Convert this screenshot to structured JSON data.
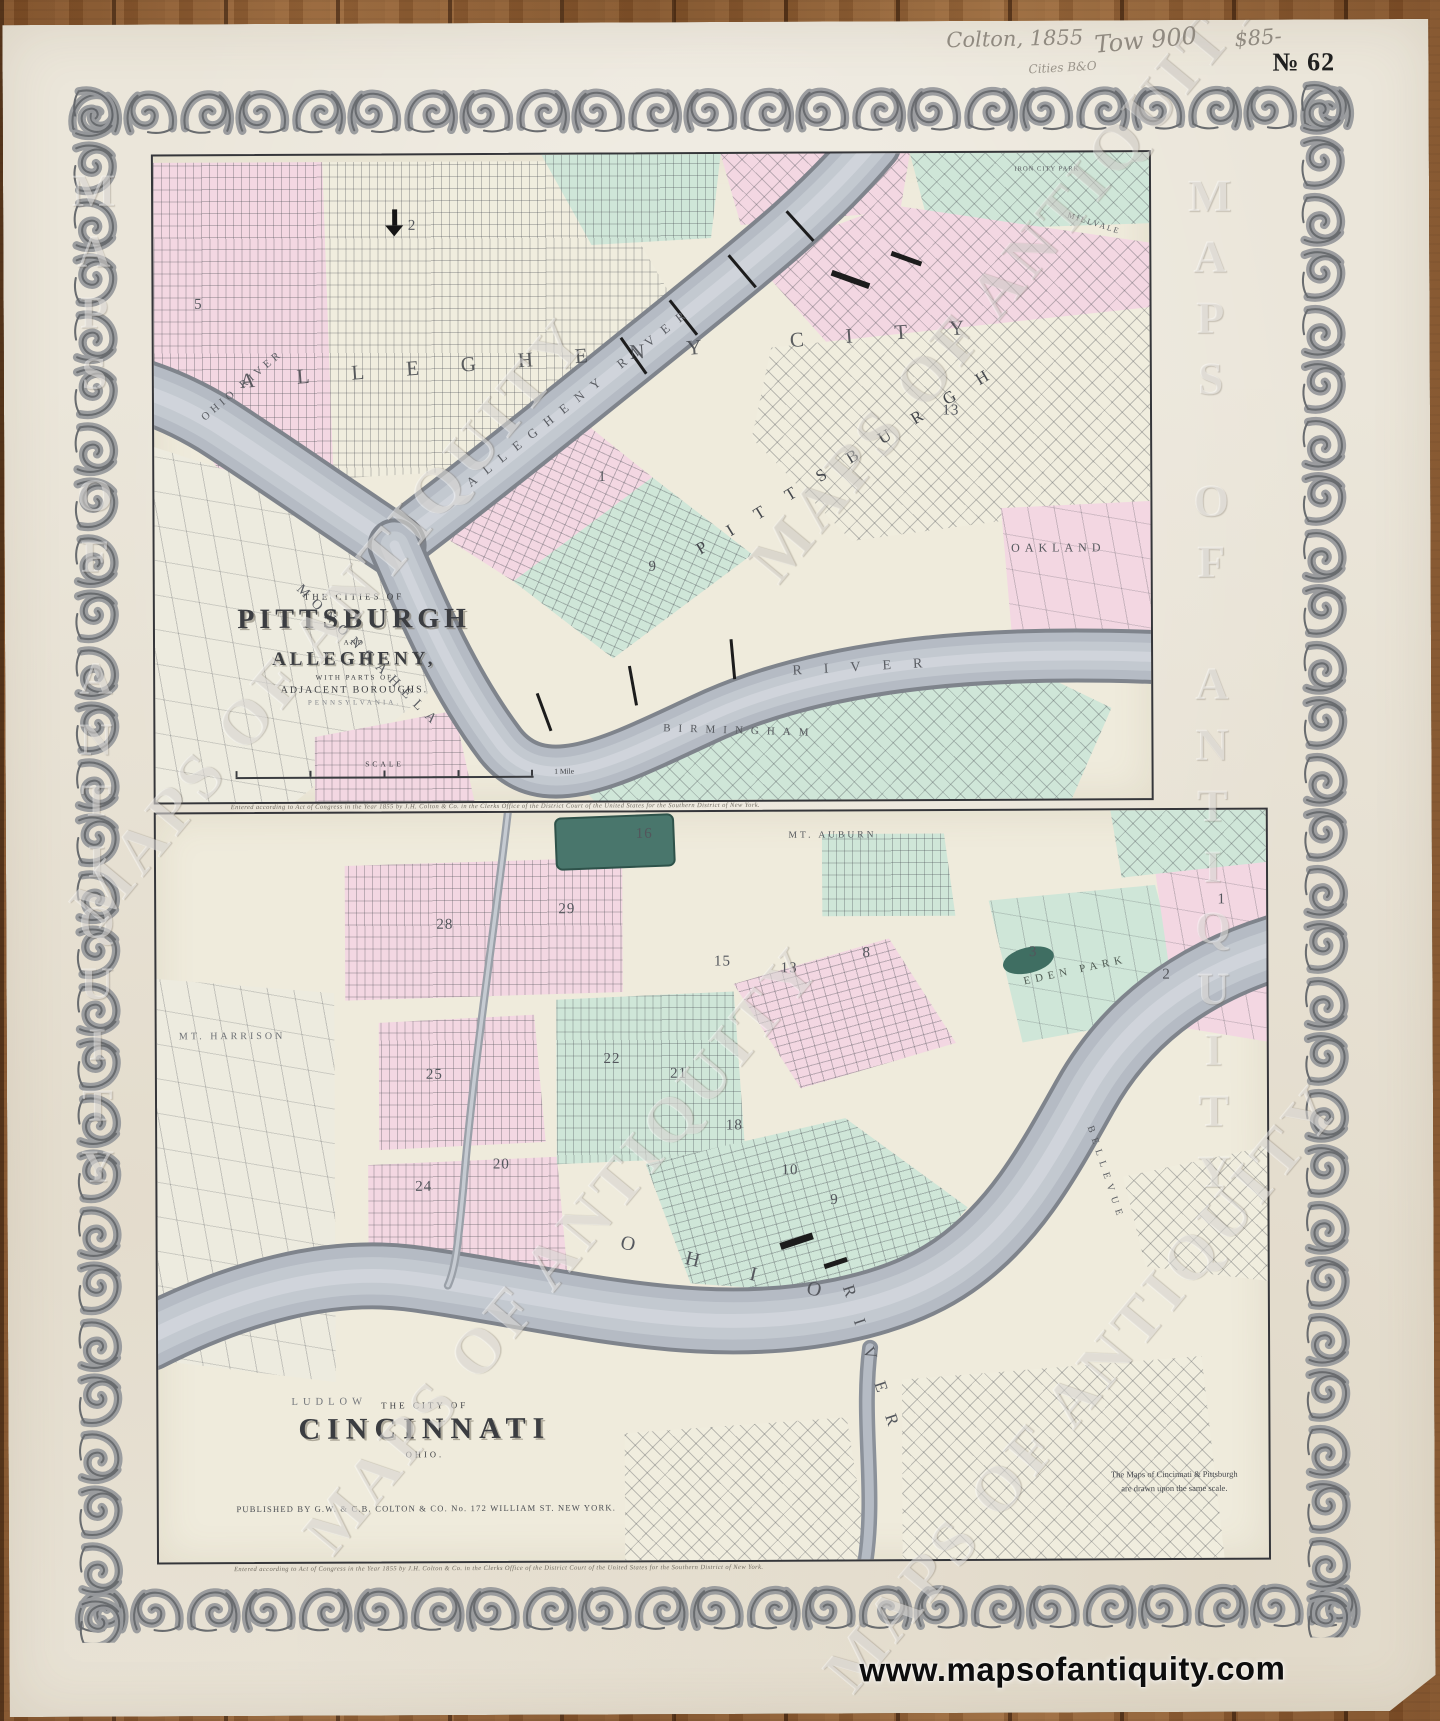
{
  "photo": {
    "annotations": {
      "pencil_note_1": "Colton, 1855",
      "pencil_note_2": "Tow 900",
      "pencil_note_3": "Cities B&O",
      "pencil_price": "$85-",
      "plate_number": "№ 62"
    },
    "watermark_text": "MAPS OF ANTIQUITY",
    "website_url": "www.mapsofantiquity.com"
  },
  "fine_print": "Entered according to Act of Congress in the Year 1855 by J.H. Colton & Co. in the Clerks Office of the District Court of the United States for the Southern District of New York.",
  "pittsburgh_map": {
    "title_cartouche": {
      "line1": "THE CITIES OF",
      "line2": "PITTSBURGH",
      "line3": "AND",
      "line4": "ALLEGHENY,",
      "line5": "WITH PARTS OF",
      "line6": "ADJACENT BOROUGHS.",
      "line7": "PENNSYLVANIA."
    },
    "scale_bar": {
      "label": "SCALE",
      "unit": "1 Mile"
    },
    "labels": {
      "allegheny_city": "ALLEGHENY CITY",
      "ohio_river": "OHIO RIVER",
      "allegheny_river": "ALLEGHENY RIVER",
      "monongahela": "MONONGAHELA",
      "monongahela_river_word": "RIVER",
      "pittsburgh": "PITTSBURGH",
      "oakland": "OAKLAND",
      "birmingham": "BIRMINGHAM",
      "iron_city_park": "IRON CITY PARK",
      "millvale": "MILLVALE"
    },
    "ward_numbers": [
      "5",
      "2",
      "1",
      "13",
      "9"
    ]
  },
  "cincinnati_map": {
    "title_cartouche": {
      "line1": "THE CITY OF",
      "line2": "CINCINNATI",
      "line3": "OHIO."
    },
    "publisher_imprint": "PUBLISHED BY G.W. & C.B. COLTON & CO. No. 172 WILLIAM ST. NEW YORK.",
    "note_line1": "The Maps of Cincinnati & Pittsburgh",
    "note_line2": "are drawn upon the same scale.",
    "labels": {
      "ohio_word": "OHIO",
      "river_word": "RIVER",
      "ludlow": "LUDLOW",
      "eden_park": "EDEN PARK",
      "mt_auburn": "MT. AUBURN",
      "mt_harrison": "MT. HARRISON",
      "bellevue": "BELLEVUE"
    },
    "ward_numbers": [
      "28",
      "29",
      "25",
      "24",
      "20",
      "22",
      "21",
      "18",
      "15",
      "13",
      "16",
      "10",
      "9",
      "8",
      "3",
      "2",
      "1"
    ]
  }
}
